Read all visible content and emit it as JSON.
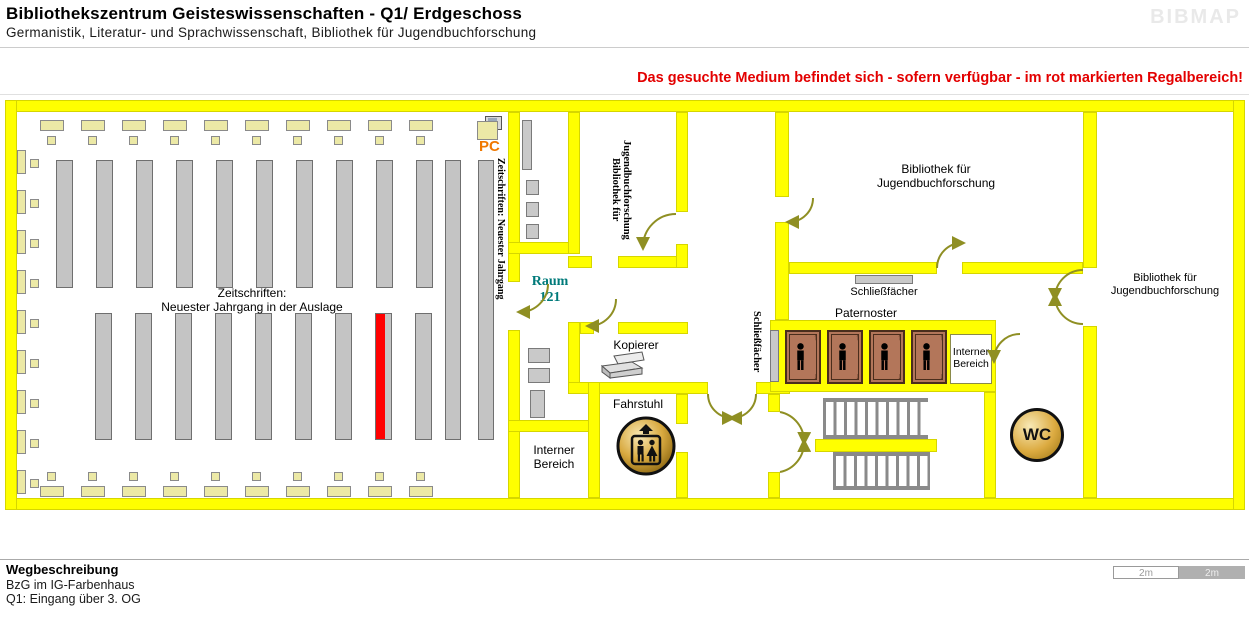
{
  "header": {
    "title": "Bibliothekszentrum Geisteswissenschaften - Q1/ Erdgeschoss",
    "subtitle": "Germanistik, Literatur- und Sprachwissenschaft, Bibliothek für Jugendbuchforschung",
    "logo": "BIBMAP",
    "notice": "Das gesuchte Medium befindet sich - sofern verfügbar -  im rot markierten Regalbereich!"
  },
  "plan": {
    "reading_room": {
      "note_line1": "Zeitschriften:",
      "note_line2": "Neuester Jahrgang in der Auslage",
      "side_label": "Zeitschriften: Neuester Jahrgang",
      "pc_label": "PC"
    },
    "rooms": {
      "jugendbuch_vertical": {
        "line1": "Bibliothek für",
        "line2": "Jugendbuchforschung"
      },
      "jugendbuch_top": {
        "line1": "Bibliothek für",
        "line2": "Jugendbuchforschung"
      },
      "jugendbuch_right": {
        "line1": "Bibliothek für",
        "line2": "Jugendbuchforschung"
      },
      "raum121": {
        "line1": "Raum",
        "line2": "121"
      },
      "kopierer": "Kopierer",
      "fahrstuhl": "Fahrstuhl",
      "interner_left": {
        "line1": "Interner",
        "line2": "Bereich"
      },
      "interner_right": {
        "line1": "Interner",
        "line2": "Bereich"
      },
      "paternoster": "Paternoster",
      "schliessfaecher": "Schließfächer",
      "schliessfaecher_vertical": "Schließfächer",
      "wc": "WC"
    }
  },
  "footer": {
    "heading": "Wegbeschreibung",
    "line1": "BzG im IG-Farbenhaus",
    "line2": "Q1: Eingang über 3. OG"
  },
  "scalebar": {
    "left": "2m",
    "right": "2m"
  },
  "colors": {
    "wall": "#ffff00",
    "table": "#ece9a6",
    "highlight": "#ff0000",
    "door": "#8f8f23",
    "room_teal": "#007a7a",
    "notice_red": "#e30000",
    "cabin_brown": "#b3765a",
    "pc_orange": "#f07800",
    "gold": "#d8a93f"
  }
}
